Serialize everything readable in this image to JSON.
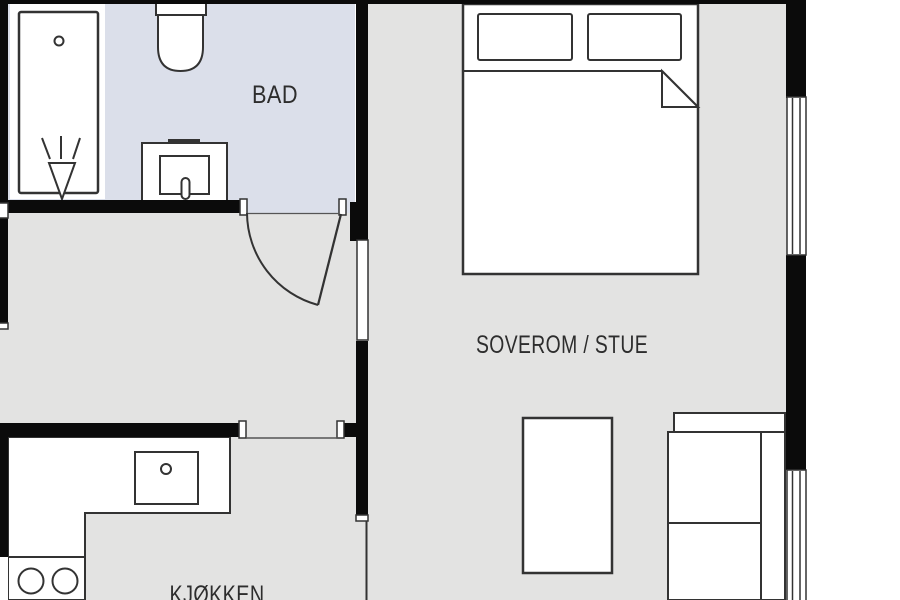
{
  "plan": {
    "title": "apartment-floor-plan",
    "rooms": [
      {
        "id": "bad",
        "label": "BAD",
        "floor_color": "#dbdfea"
      },
      {
        "id": "soverom-stue",
        "label": "SOVEROM / STUE",
        "floor_color": "#e3e3e2"
      },
      {
        "id": "kjokken",
        "label": "KJØKKEN",
        "floor_color": "#e3e3e2"
      },
      {
        "id": "hall",
        "label": "",
        "floor_color": "#e3e3e2"
      }
    ],
    "colors": {
      "wall": "#0b0b0b",
      "fixture_fill": "#ffffff",
      "fixture_outline": "#333333",
      "label_text": "#2d2d2d",
      "outside": "#ffffff",
      "bath_floor": "#dbdfea",
      "room_floor": "#e3e3e2"
    },
    "fixtures": [
      "bathtub-shower",
      "toilet",
      "washbasin",
      "double-bed",
      "pillow",
      "duvet-fold",
      "coffee-table",
      "sofa",
      "kitchen-counter",
      "kitchen-sink",
      "stove",
      "window",
      "door-swing"
    ]
  }
}
